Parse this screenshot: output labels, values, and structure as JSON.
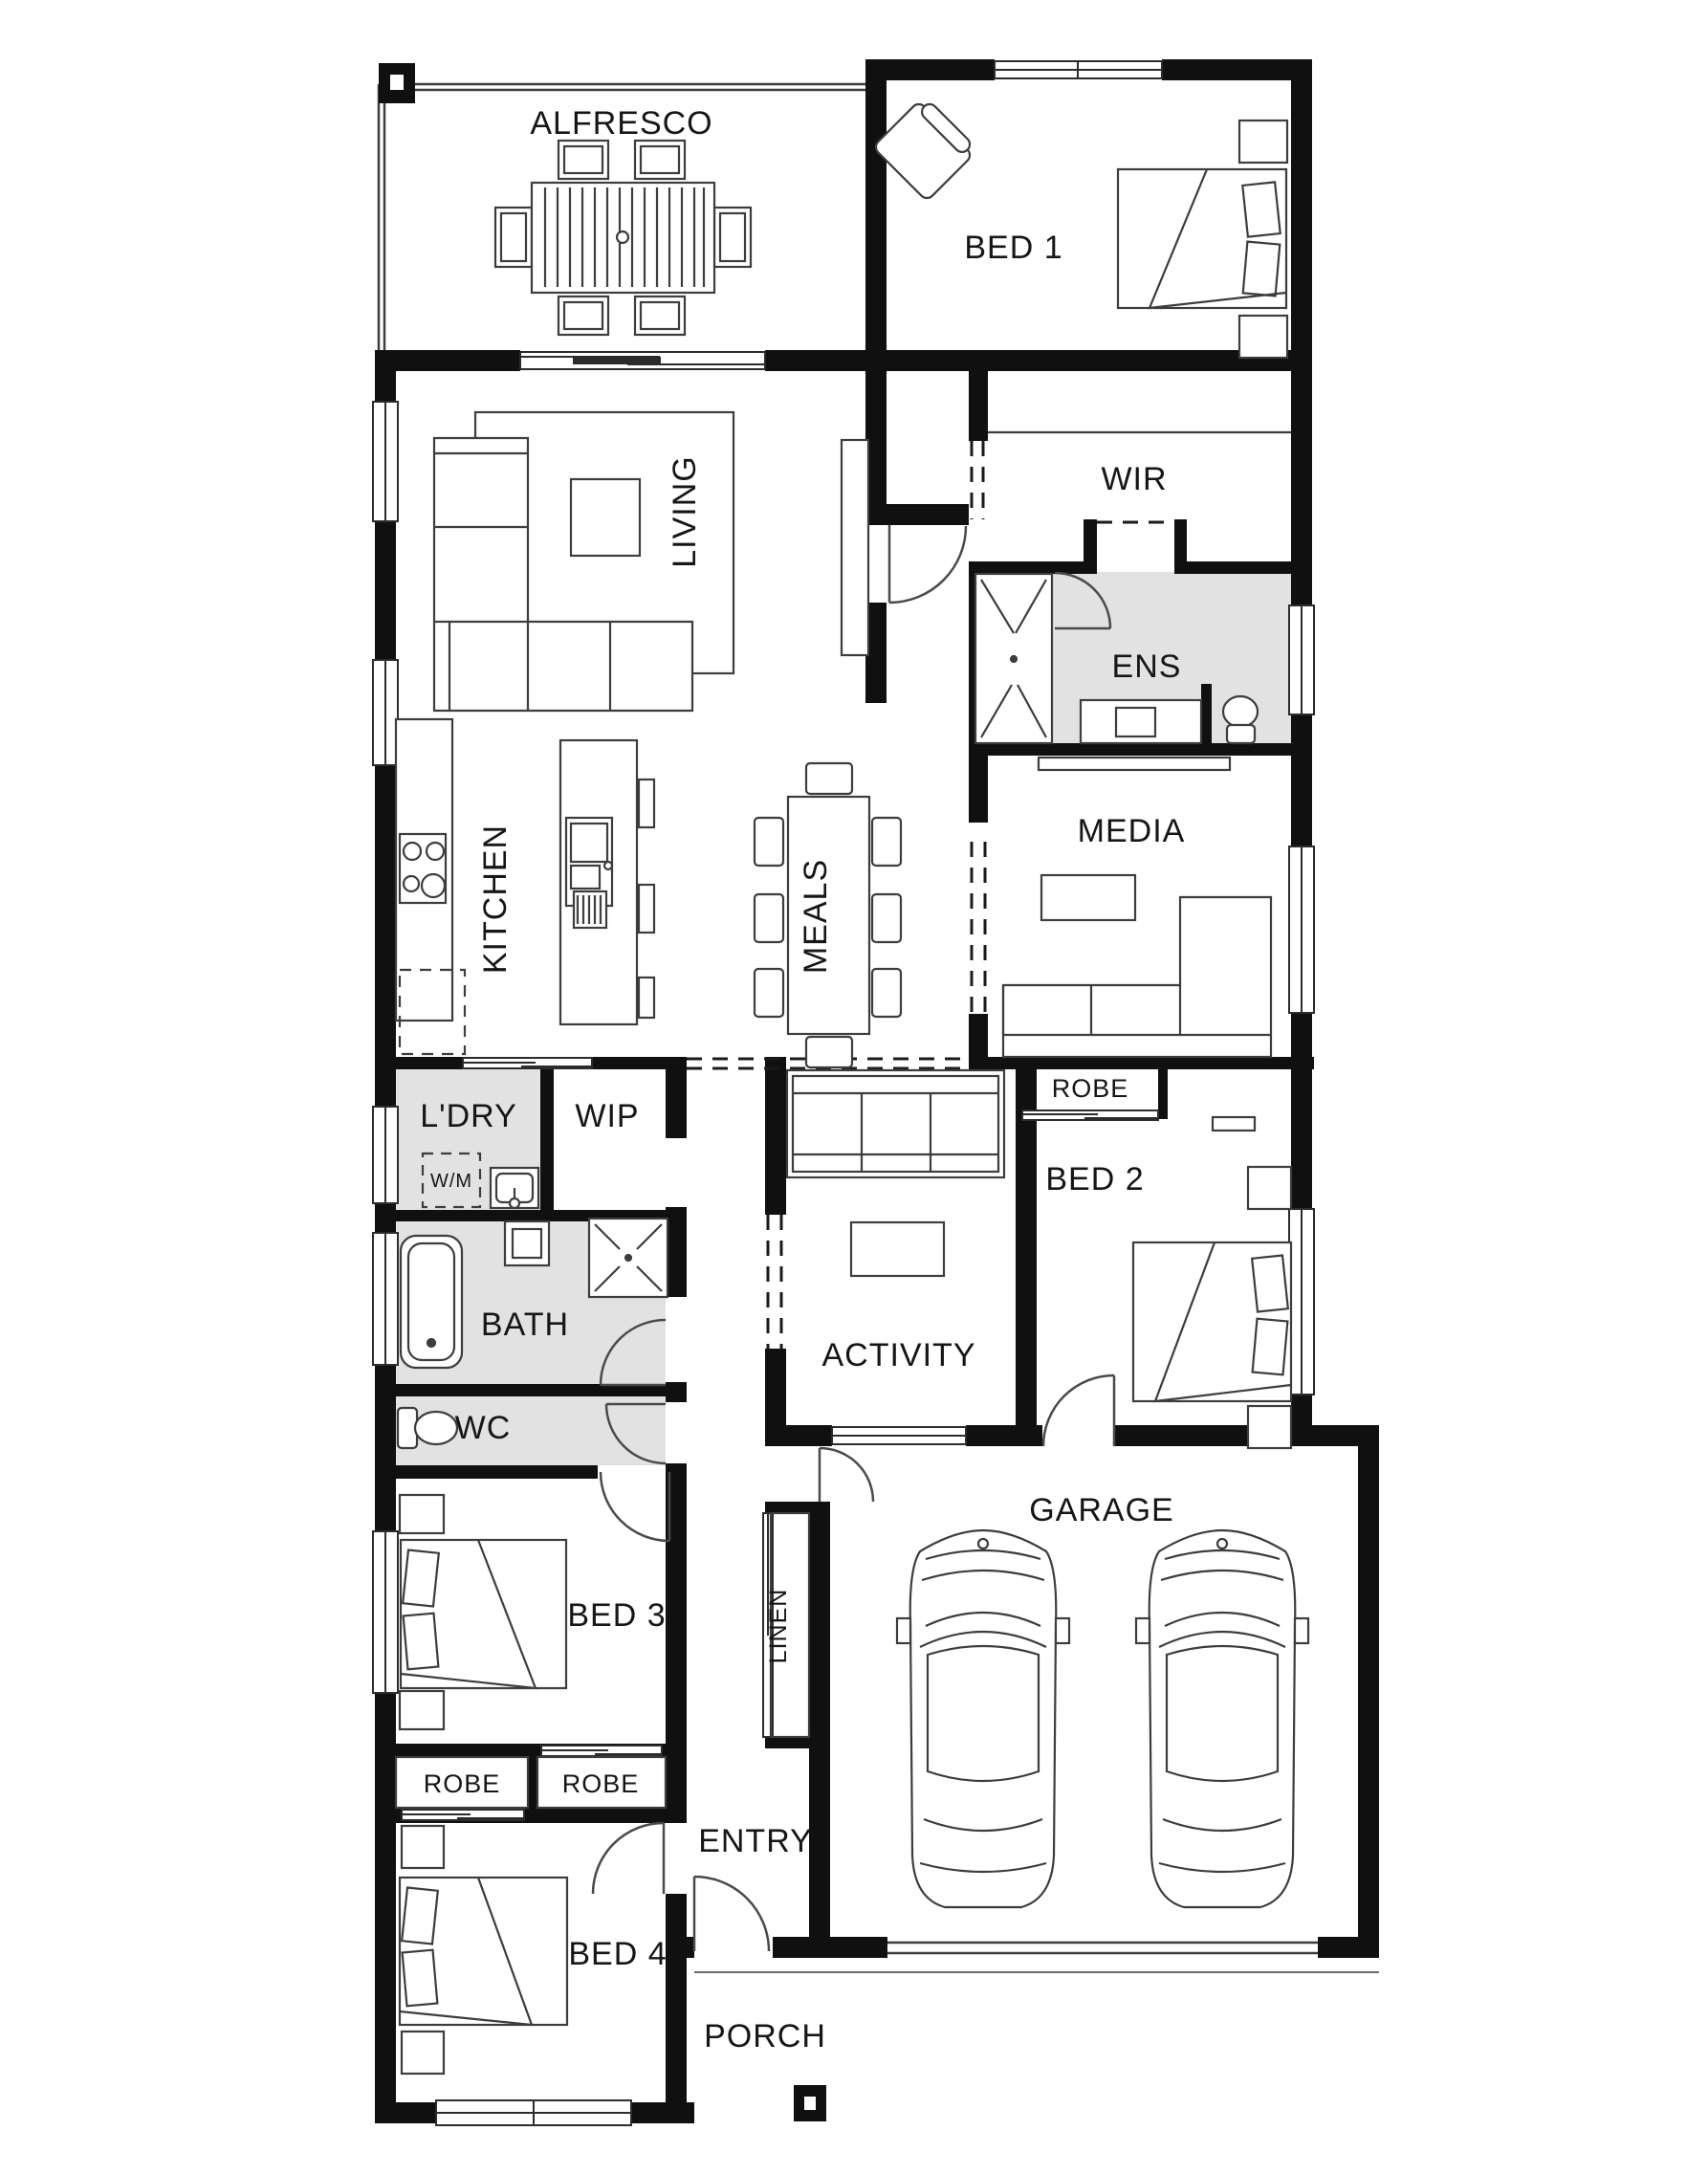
{
  "colors": {
    "wall": "#101010",
    "furniture_line": "#3d3d3d",
    "door_line": "#4a4a4a",
    "room_shade": "#e2e2e2",
    "background": "#ffffff",
    "label": "#161616"
  },
  "rooms": [
    {
      "id": "alfresco",
      "label": "ALFRESCO"
    },
    {
      "id": "bed1",
      "label": "BED 1"
    },
    {
      "id": "living",
      "label": "LIVING"
    },
    {
      "id": "wir",
      "label": "WIR"
    },
    {
      "id": "ens",
      "label": "ENS"
    },
    {
      "id": "kitchen",
      "label": "KITCHEN"
    },
    {
      "id": "meals",
      "label": "MEALS"
    },
    {
      "id": "media",
      "label": "MEDIA"
    },
    {
      "id": "ldry",
      "label": "L'DRY"
    },
    {
      "id": "wip",
      "label": "WIP"
    },
    {
      "id": "wm",
      "label": "W/M"
    },
    {
      "id": "robe_bed2",
      "label": "ROBE"
    },
    {
      "id": "bed2",
      "label": "BED 2"
    },
    {
      "id": "bath",
      "label": "BATH"
    },
    {
      "id": "activity",
      "label": "ACTIVITY"
    },
    {
      "id": "wc",
      "label": "WC"
    },
    {
      "id": "garage",
      "label": "GARAGE"
    },
    {
      "id": "linen",
      "label": "LINEN"
    },
    {
      "id": "bed3",
      "label": "BED 3"
    },
    {
      "id": "robe_bed4",
      "label": "ROBE"
    },
    {
      "id": "robe_bed3",
      "label": "ROBE"
    },
    {
      "id": "entry",
      "label": "ENTRY"
    },
    {
      "id": "bed4",
      "label": "BED 4"
    },
    {
      "id": "porch",
      "label": "PORCH"
    }
  ],
  "icons": [
    "outdoor-dining-table-icon",
    "armchair-icon",
    "double-bed-icon",
    "corner-sofa-icon",
    "coffee-table-icon",
    "tv-unit-icon",
    "cooktop-icon",
    "island-sink-icon",
    "fridge-space-icon",
    "dining-table-icon",
    "shower-icon",
    "vanity-basin-icon",
    "toilet-icon",
    "washing-machine-icon",
    "laundry-trough-icon",
    "bathtub-icon",
    "car-icon",
    "column-icon",
    "window-icon",
    "door-swing-icon"
  ]
}
